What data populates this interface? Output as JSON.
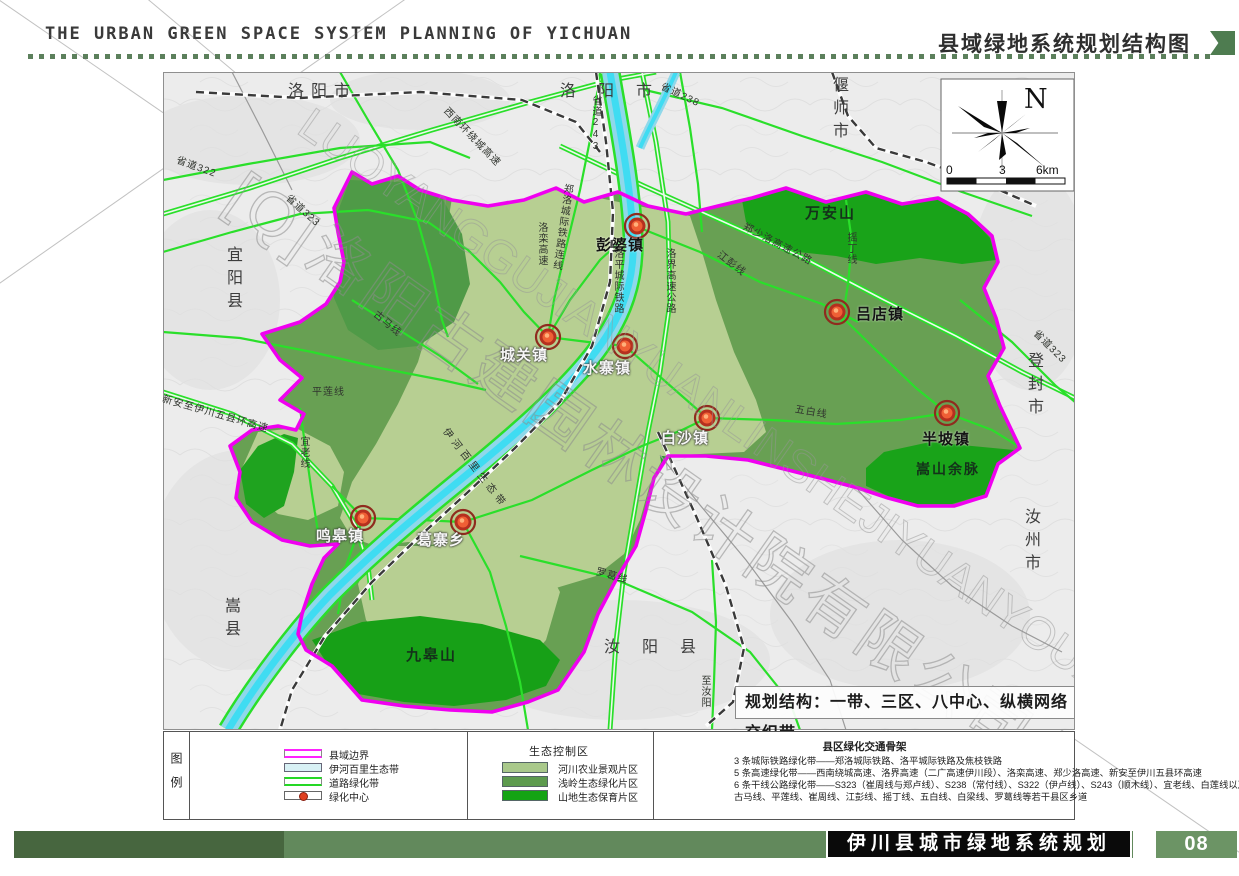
{
  "header": {
    "title_en": "THE URBAN GREEN SPACE SYSTEM PLANNING OF YICHUAN",
    "title_cn": "县域绿地系统规划结构图"
  },
  "map": {
    "neighbors": [
      "洛阳市",
      "洛阳市",
      "偃师市",
      "宜阳县",
      "登封市",
      "汝州市",
      "汝阳县",
      "嵩县"
    ],
    "towns": [
      "彭婆镇",
      "吕店镇",
      "城关镇",
      "水寨镇",
      "白沙镇",
      "半坡镇",
      "鸣皋镇",
      "葛寨乡"
    ],
    "mountains": [
      "万安山",
      "嵩山余脉",
      "九皋山"
    ],
    "road_labels": [
      "省道322",
      "省道323",
      "省道243",
      "省道238",
      "西南环绕城高速",
      "郑洛城际铁路连线",
      "洛栾高速",
      "洛平城际铁路",
      "洛界高速公路",
      "郑少洛高速公路",
      "江彭线",
      "摇丁线",
      "省道323",
      "五白线",
      "罗葛线",
      "至汝阳",
      "新安至伊川五县环高速",
      "平莲线",
      "古马线",
      "宜老线",
      "伊河百里生态带"
    ],
    "compass": {
      "north": "N",
      "ticks": [
        "0",
        "3",
        "6km"
      ]
    },
    "planning_note": "规划结构：一带、三区、八中心、纵横网络交织带",
    "watermark": {
      "cjk": "[Q]洛阳古建园林设计院有限公司",
      "latin": "LUOYANGGUJIANYUANLINSHEJIYUANYOUXIANGONGSI"
    },
    "colors": {
      "county_boundary": "#f000f0",
      "river_band": "#8fd8ea",
      "river_core": "#3fdcf2",
      "road_green": "#2adf2a",
      "zone_pale": "#b7cf92",
      "zone_medium": "#68a053",
      "zone_dark": "#19a319"
    }
  },
  "legend": {
    "panel_label": "图例",
    "items": [
      "县域边界",
      "伊河百里生态带",
      "道路绿化带",
      "绿化中心"
    ],
    "eco": {
      "header": "生态控制区",
      "items": [
        {
          "label": "河川农业景观片区",
          "color": "#a9c98b"
        },
        {
          "label": "浅岭生态绿化片区",
          "color": "#5d9b4e"
        },
        {
          "label": "山地生态保育片区",
          "color": "#14a314"
        }
      ]
    },
    "transport": {
      "header": "县区绿化交通骨架",
      "lines": [
        "3 条城际铁路绿化带——郑洛城际铁路、洛平城际铁路及焦枝铁路",
        "5 条高速绿化带——西南绕城高速、洛界高速（二广高速伊川段）、洛栾高速、郑少洛高速、新安至伊川五县环高速",
        "6 条干线公路绿化带——S323（崔周线与郑卢线）、S238（常付线）、S322（伊卢线）、S243（顺木线）、宜老线、白莲线以及",
        "古马线、平莲线、崔周线、江彭线、摇丁线、五白线、白梁线、罗葛线等若干县区乡道"
      ]
    }
  },
  "footer": {
    "title": "伊川县城市绿地系统规划",
    "page": "08"
  }
}
